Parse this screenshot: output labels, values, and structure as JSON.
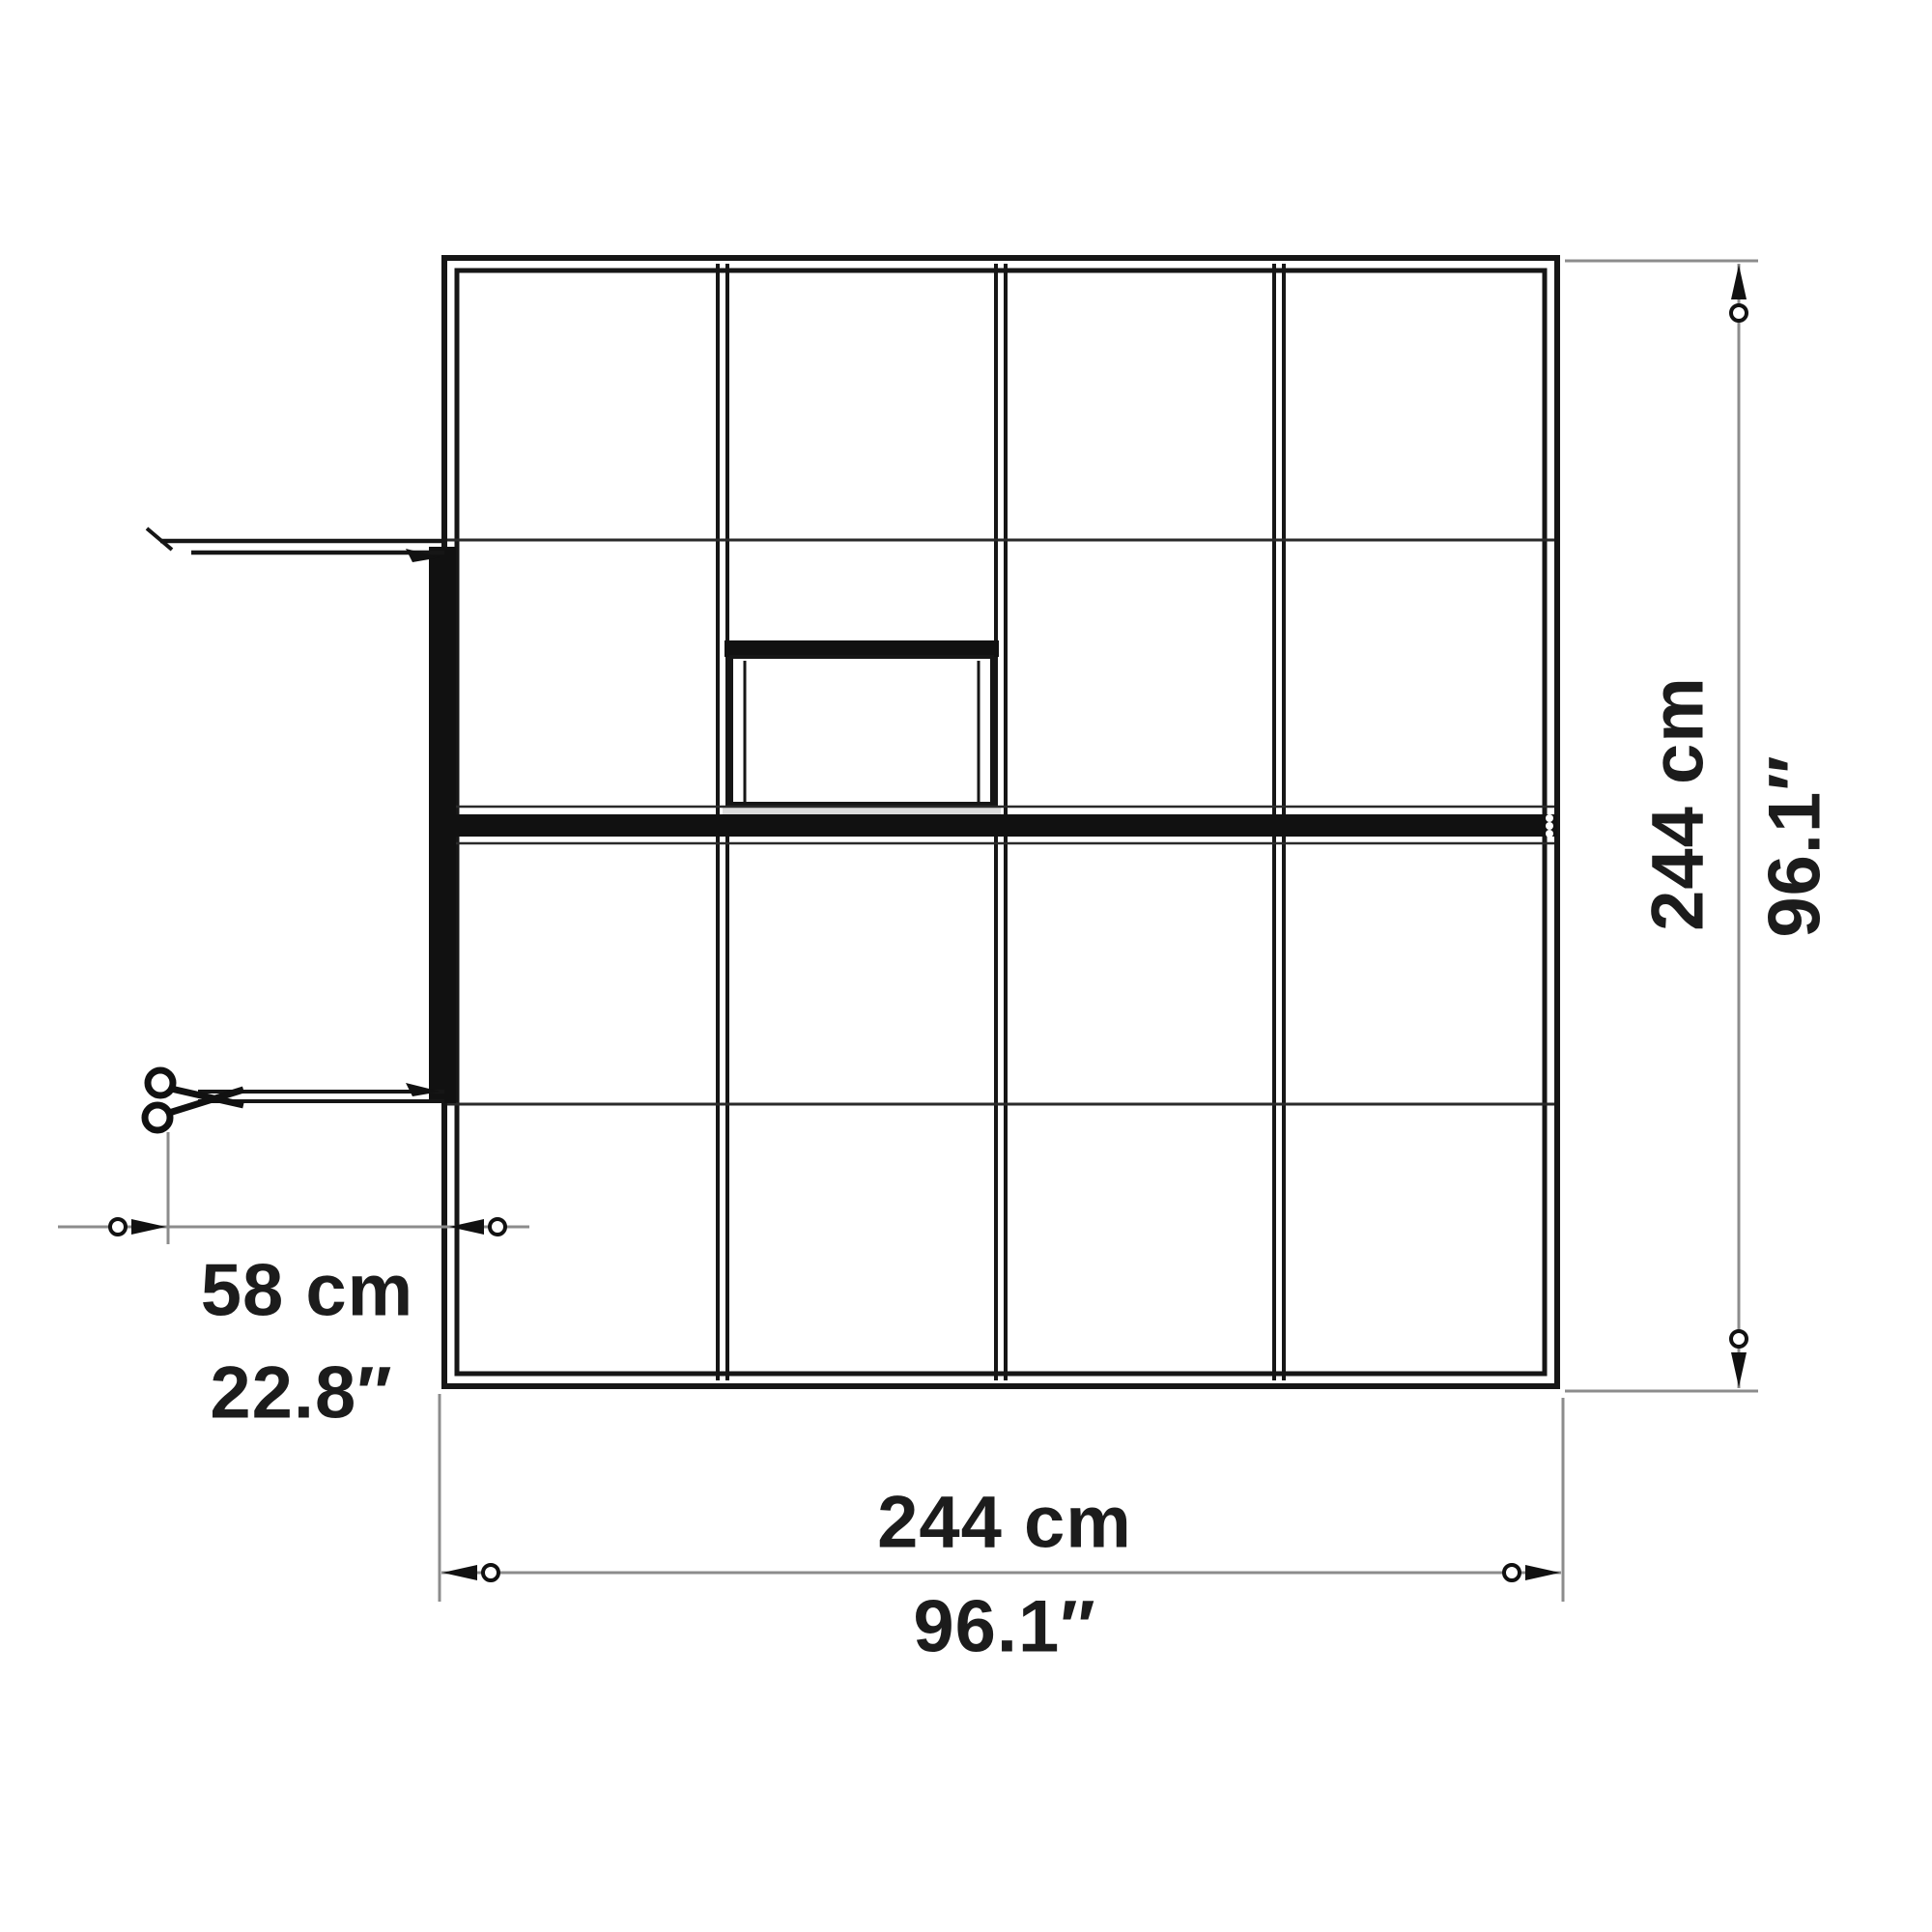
{
  "figure": {
    "type": "technical-dimension-drawing",
    "subject": "greenhouse top view floor plan",
    "background_color": "#ffffff",
    "line_color": "#161616",
    "dimension_line_color": "#8c8c8c",
    "text_color": "#1c1c1c"
  },
  "plan": {
    "grid": {
      "columns": 4,
      "rows": 4,
      "has_center_ridge": true,
      "has_roof_vent_window": true,
      "has_left_shelf_flap": true,
      "has_left_door_with_handle": true
    }
  },
  "dims": {
    "right": {
      "metric": "244 cm",
      "imperial": "96.1″"
    },
    "bottom": {
      "metric": "244 cm",
      "imperial": "96.1″"
    },
    "door_offset": {
      "metric": "58 cm",
      "imperial": "22.8″"
    }
  }
}
